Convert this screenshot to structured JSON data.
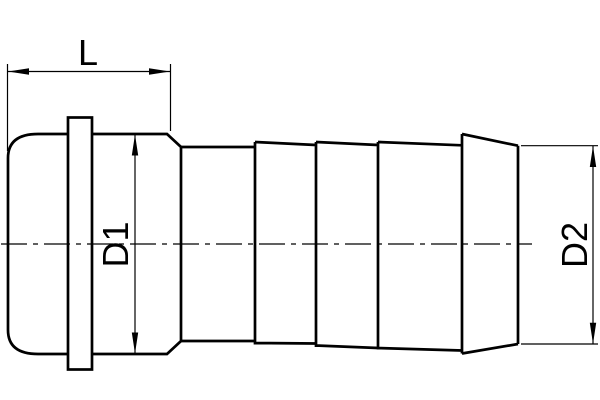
{
  "page": {
    "background_color": "#ffffff"
  },
  "diagram": {
    "kind": "technical-drawing",
    "subject": "hose barb fitting side view with nut cap, flange tab and serrated hose tail",
    "line_color": "#000000",
    "labels": {
      "length": "L",
      "diameter_cap": "D1",
      "diameter_tail": "D2"
    }
  }
}
